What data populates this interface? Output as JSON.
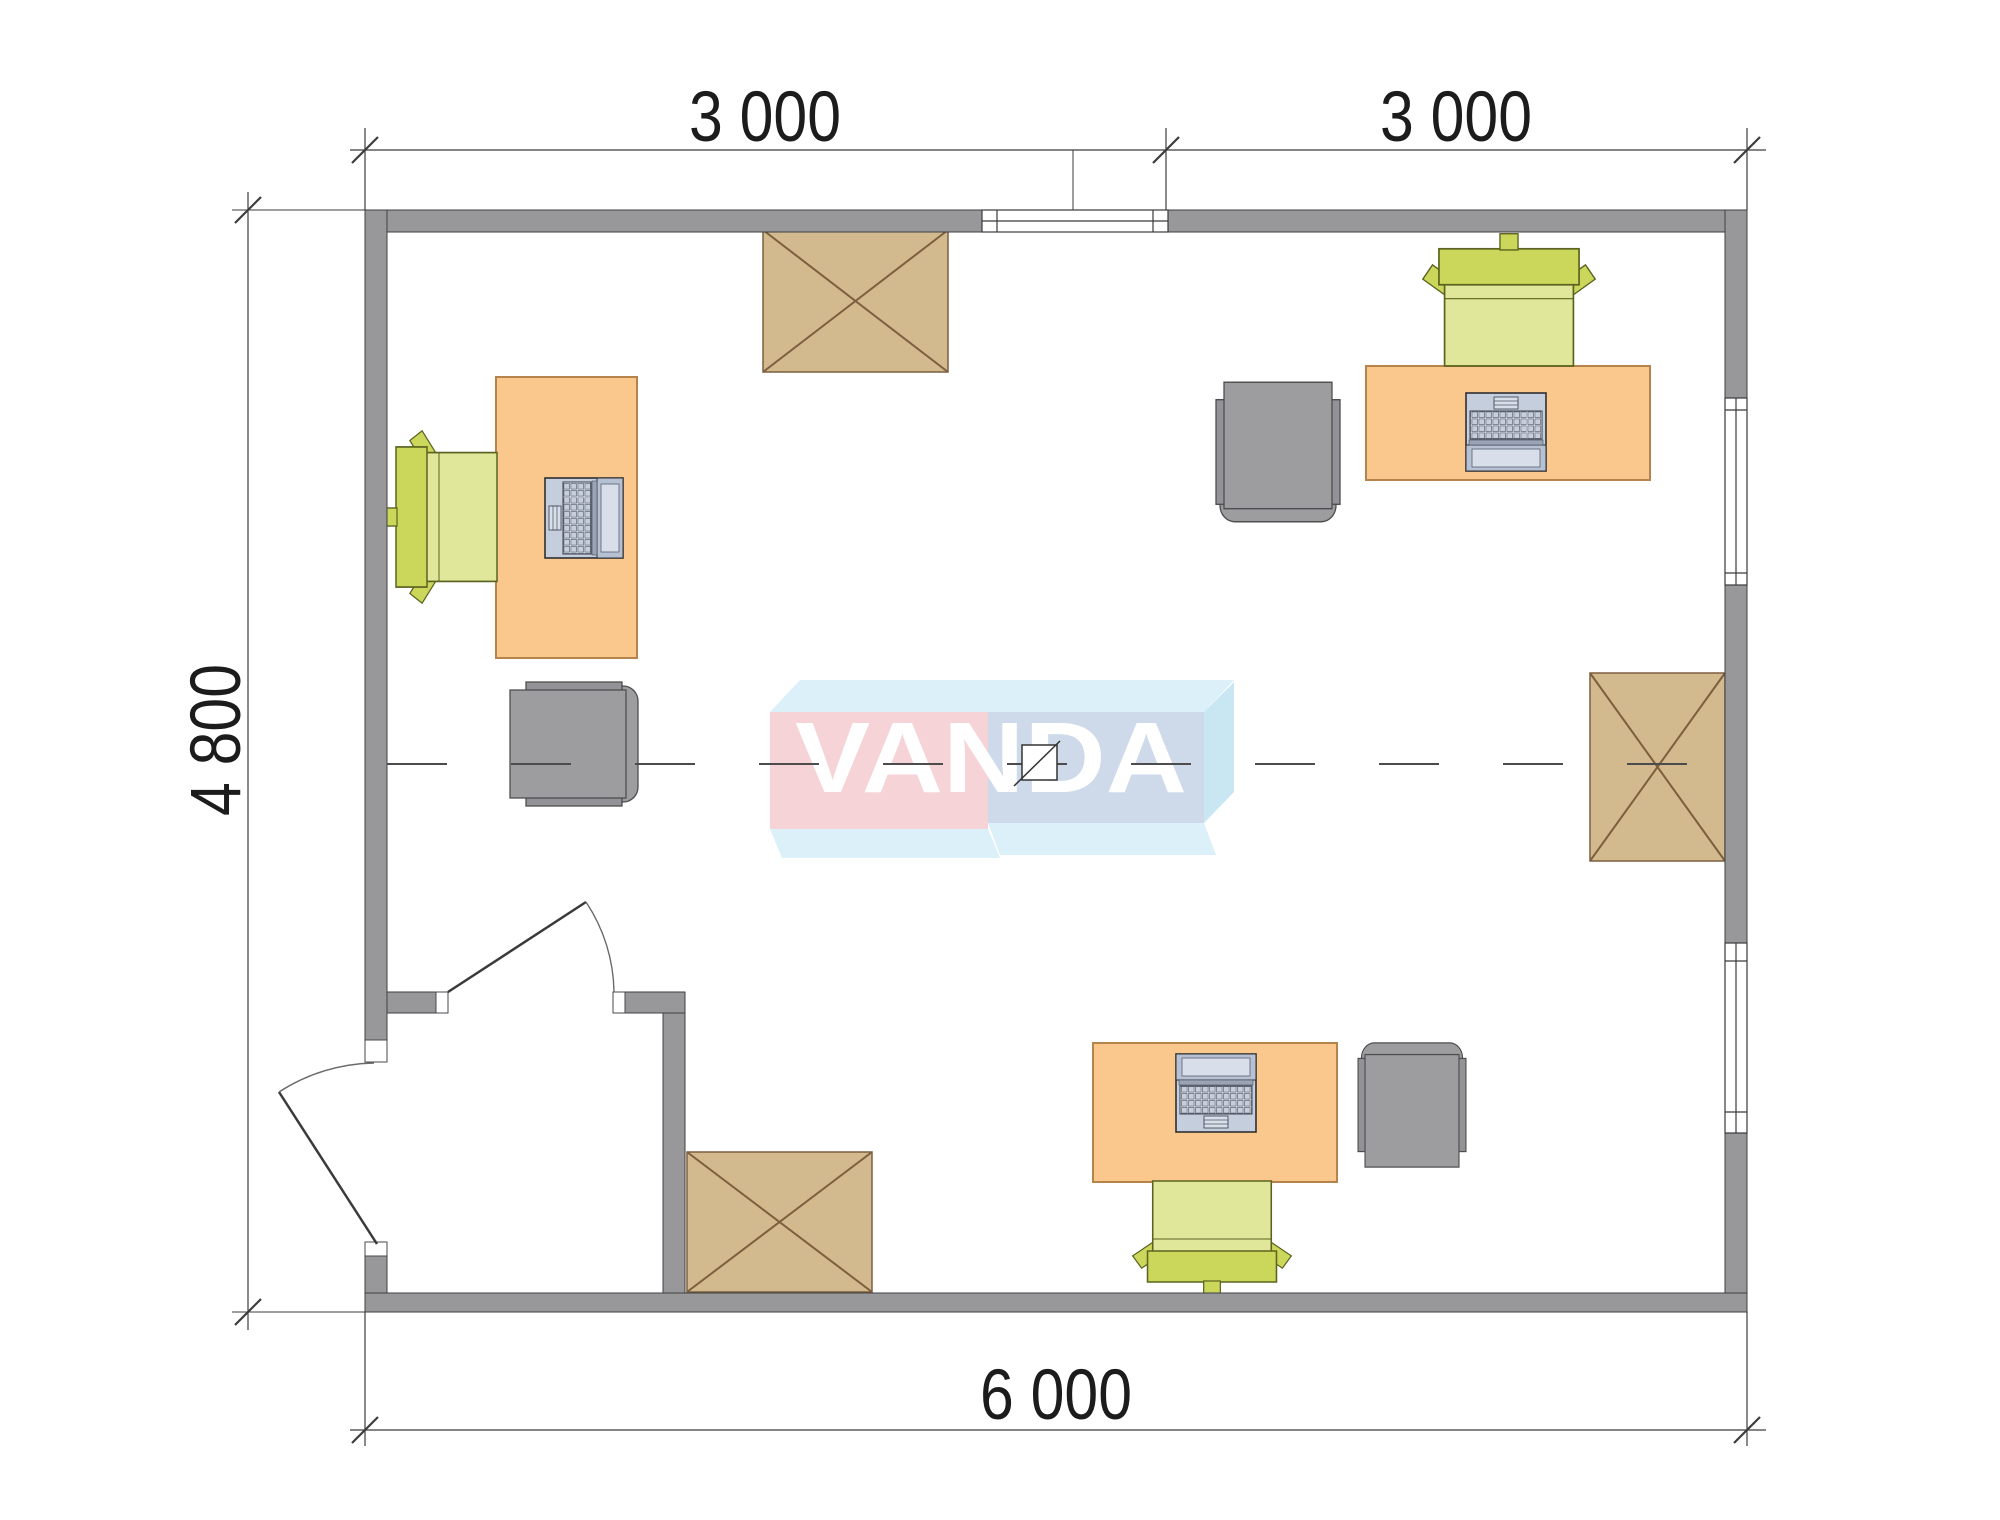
{
  "plan": {
    "type": "office-floor-plan",
    "watermark_logo": {
      "text": "VANDA"
    },
    "dimensions": {
      "top_left_label": "3 000",
      "top_right_label": "3 000",
      "left_label": "4 800",
      "bottom_label": "6 000",
      "top_left_value_mm": 3000,
      "top_right_value_mm": 3000,
      "left_value_mm": 4800,
      "bottom_value_mm": 6000
    },
    "rooms": {
      "main_room_furniture": [
        "desk-with-laptop-left",
        "office-chair-left",
        "armchair-left",
        "desk-with-laptop-top-right",
        "office-chair-top-right",
        "armchair-top-right",
        "desk-with-laptop-bottom",
        "office-chair-bottom",
        "armchair-bottom",
        "crossed-box-top",
        "crossed-box-bottom-left",
        "crossed-box-right"
      ],
      "openings": [
        "window-top",
        "window-right-upper",
        "window-right-lower",
        "interior-door",
        "entry-door"
      ]
    }
  },
  "theme": {
    "wall": "#98989B",
    "wall_line": "#3F3F41",
    "desk": "#FAC78C",
    "desk_line": "#B5834C",
    "chair_seat": "#E0E79B",
    "chair_back": "#CBD75B",
    "chair_line": "#5C6320",
    "arm": "#9D9DA0",
    "arm_2": "#939397",
    "arm_line": "#4E4E50",
    "box": "#D3B98E",
    "box_line": "#7C5F3E",
    "lap": "#C5CEDD",
    "lap_2": "#D8DFEA",
    "lap_line": "#2F2F33",
    "line": "#3C3C3E",
    "dim": "#1C1C1C",
    "logo_pink": "#F6D3D7",
    "logo_cyan": "#DCF0F9",
    "logo_steel": "#CEDAE9",
    "logo_side": "#C9E6F3",
    "logo_text": "#FFFFFF"
  }
}
